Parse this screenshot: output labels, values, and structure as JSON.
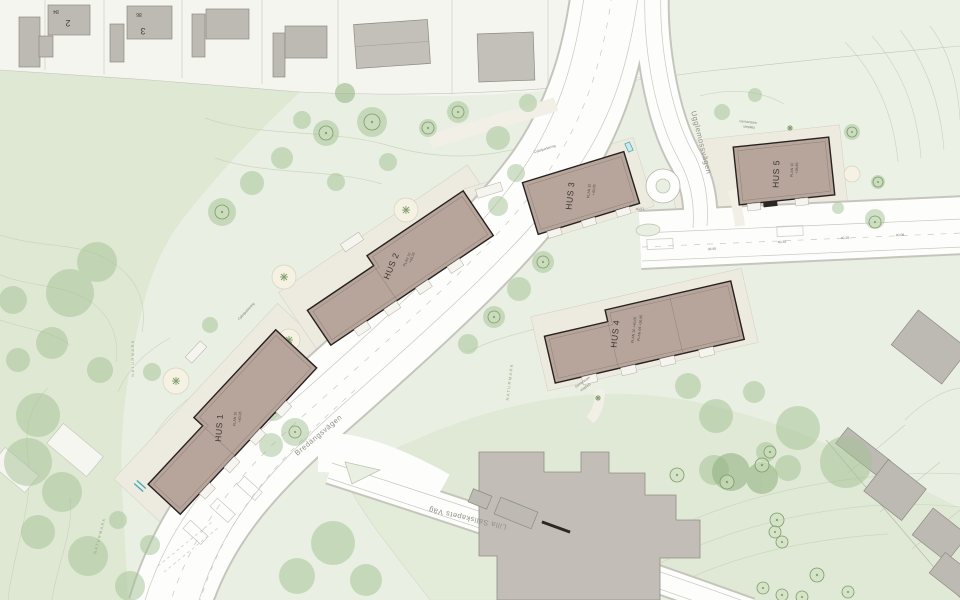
{
  "map": {
    "buildings": [
      {
        "name": "HUS 1",
        "l1": "PLAN 10",
        "l2": "+40,05"
      },
      {
        "name": "HUS 2",
        "l1": "PLAN 10",
        "l2": "+40,05"
      },
      {
        "name": "HUS 3",
        "l1": "PLAN 10",
        "l2": "+40,05"
      },
      {
        "name": "HUS 4",
        "l1": "PLAN 10 +40,05",
        "l2": "PLAN 09 +36,85"
      },
      {
        "name": "HUS 5",
        "l1": "PLAN 10",
        "l2": "+38,85"
      }
    ],
    "roads": {
      "main": "Bredängsvägen",
      "south": "Lilla Sällskapets Väg",
      "north": "Ugglemossvägen"
    },
    "labels": {
      "naturmark": "NATURMARK",
      "common_area_1": "Gemensam",
      "common_area_2": "uteplats",
      "bike_parking": "Cykelparkering"
    },
    "plots": [
      {
        "plot": "84",
        "house": "2"
      },
      {
        "plot": "86",
        "house": "3"
      }
    ],
    "elevations": [
      "40,35",
      "40,28",
      "40,08",
      "39,95",
      "40,51"
    ],
    "colors": {
      "background_green": "#e9efe2",
      "natural_green": "#dfe8d3",
      "road_white": "#fdfdfb",
      "new_building": "#b7a59b",
      "existing_building": "#bdbab3",
      "tree_green": "#a4c294",
      "accent_teal": "#45aab8"
    }
  }
}
